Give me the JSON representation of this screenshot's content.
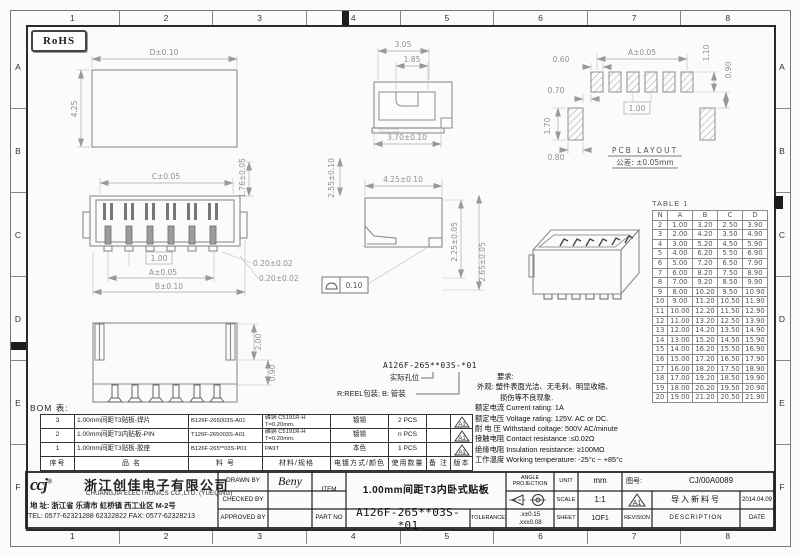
{
  "sheet": {
    "grid_cols": [
      "1",
      "2",
      "3",
      "4",
      "5",
      "6",
      "7",
      "8"
    ],
    "grid_rows": [
      "A",
      "B",
      "C",
      "D",
      "E",
      "F"
    ],
    "rohs_label": "RoHS"
  },
  "views": {
    "plan": {
      "width": "D±0.10",
      "height": "4.25"
    },
    "front": {
      "top": "C±0.05",
      "right": "1.76±0.05",
      "pitch": "1.00",
      "span": "A±0.05",
      "width": "B±0.10",
      "pin1": "0.20±0.02",
      "pin2": "0.20±0.02"
    },
    "section": {
      "d1": "3.05",
      "d2": "1.85",
      "d3": "3.70±0.10"
    },
    "side": {
      "h": "2.55±0.10",
      "w": "4.25±0.10",
      "p1": "2.25±0.05",
      "p2": "2.65±0.05",
      "flatness": "0.10"
    },
    "bottom": {
      "d1": "2.00",
      "d2": "0.90"
    },
    "pcb": {
      "title": "PCB  LAYOUT",
      "tol": "公差: ±0.05mm",
      "pad_w": "0.60",
      "span": "A±0.05",
      "d1": "1.10",
      "d2": "0.90",
      "d3": "0.70",
      "d4": "1.70",
      "pitch": "1.00",
      "d5": "0.80"
    }
  },
  "part_code": {
    "number": "A126F-265**03S-*01",
    "note_hole": "实际孔位",
    "note_pack": "R:REEL包装; B: 管装"
  },
  "dim_table": {
    "title": "TABLE 1",
    "headers": [
      "N",
      "A",
      "B",
      "C",
      "D"
    ],
    "rows": [
      [
        "2",
        "1.00",
        "3.20",
        "2.50",
        "3.90"
      ],
      [
        "3",
        "2.00",
        "4.20",
        "3.50",
        "4.90"
      ],
      [
        "4",
        "3.00",
        "5.20",
        "4.50",
        "5.90"
      ],
      [
        "5",
        "4.00",
        "6.20",
        "5.50",
        "6.90"
      ],
      [
        "6",
        "5.00",
        "7.20",
        "6.50",
        "7.90"
      ],
      [
        "7",
        "6.00",
        "8.20",
        "7.50",
        "8.90"
      ],
      [
        "8",
        "7.00",
        "9.20",
        "8.50",
        "9.90"
      ],
      [
        "9",
        "8.00",
        "10.20",
        "9.50",
        "10.90"
      ],
      [
        "10",
        "9.00",
        "11.20",
        "10.50",
        "11.90"
      ],
      [
        "11",
        "10.00",
        "12.20",
        "11.50",
        "12.90"
      ],
      [
        "12",
        "11.00",
        "13.20",
        "12.50",
        "13.90"
      ],
      [
        "13",
        "12.00",
        "14.20",
        "13.50",
        "14.90"
      ],
      [
        "14",
        "13.00",
        "15.20",
        "14.50",
        "15.90"
      ],
      [
        "15",
        "14.00",
        "16.20",
        "15.50",
        "16.90"
      ],
      [
        "16",
        "15.00",
        "17.20",
        "16.50",
        "17.90"
      ],
      [
        "17",
        "16.00",
        "18.20",
        "17.50",
        "18.90"
      ],
      [
        "18",
        "17.00",
        "19.20",
        "18.50",
        "19.90"
      ],
      [
        "19",
        "18.00",
        "20.20",
        "19.50",
        "20.90"
      ],
      [
        "20",
        "19.00",
        "21.20",
        "20.50",
        "21.90"
      ]
    ]
  },
  "notes": {
    "require": "要求:",
    "appearance1": "外观: 塑件表面光洁、无毛刺、明显收缩、",
    "appearance2": "损伤等不良现象.",
    "lines": [
      "额定电流 Current rating: 1A",
      "额定电压 Voltage rating: 125V. AC or DC.",
      "耐 电 压 Withstand coltage: 500V AC/minute",
      "接触电阻 Contact resistance :≤0.02Ω",
      "绝缘电阻 Insulation resistance: ≥100MΩ",
      "工作温度 Working temperature: -25°c ~ +85°c"
    ]
  },
  "bom": {
    "label": "BOM 表:",
    "headers": [
      "序号",
      "品  名",
      "料  号",
      "材料/规格",
      "电镀方式/颜色",
      "使用数量",
      "备 注",
      "版本"
    ],
    "rows": [
      {
        "no": "3",
        "name": "1.00mm间距T3贴板-焊片",
        "part": "B126F-265003S-A01",
        "material": "磷铜 C5191R-H\nT=0.20mm.",
        "finish": "镀锡",
        "qty": "2 PCS",
        "remark": "",
        "rev": "A1"
      },
      {
        "no": "2",
        "name": "1.00mm间距T3内贴板-PIN",
        "part": "T126F-265003S-A01",
        "material": "磷铜 C5191R-H\nT=0.20mm.",
        "finish": "镀锡",
        "qty": "n PCS",
        "remark": "",
        "rev": "A1"
      },
      {
        "no": "1",
        "name": "1.00mm间距T3贴板-胶座",
        "part": "B126F-265**03S-P01",
        "material": "PA9T",
        "finish": "本色",
        "qty": "1 PCS",
        "remark": "",
        "rev": "A1"
      }
    ]
  },
  "title_block": {
    "logo": "ccj",
    "logo_reg": "®",
    "company_cn": "浙江创佳电子有限公司",
    "company_en": "CHUANGJIA  ELECTRONICS CO.,LTD. (YUEQING)",
    "address": "地 址: 浙江省 乐清市 虹桥镇 西工业区 M-2号",
    "tel": "TEL: 0577-62321288 62322822 FAX: 0577-62328213",
    "drawn_label": "DRAWN BY",
    "drawn": "Beny",
    "checked_label": "CHECKED BY",
    "checked": "",
    "approved_label": "APPROVED BY",
    "approved": "",
    "item_label": "ITEM",
    "item": "1.00mm间距T3内卧式贴板",
    "part_no_label": "PART NO",
    "part_no": "A126F-265**03S-*01",
    "tolerance_label": "TOLERANCE",
    "tolerance1": ".x±0.15",
    "tolerance2": ".xx±0.08",
    "angle_label": "ANGLE PROJECTION",
    "unit_label": "UNIT",
    "unit": "mm",
    "scale_label": "SCALE",
    "scale": "1:1",
    "sheet_label": "SHEET",
    "sheet": "1OF1",
    "drawing_no_label": "图号:",
    "drawing_no": "CJ/00A0089",
    "revision_label": "REVISION",
    "revision": "A1",
    "description_label": "DESCRIPTION",
    "description": "导入新料号",
    "date_label": "DATE",
    "date": "2014.04.09"
  }
}
